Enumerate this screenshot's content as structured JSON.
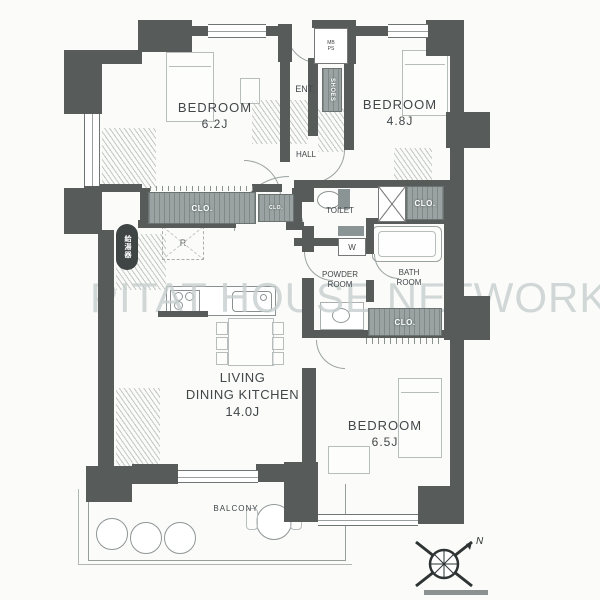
{
  "watermark": "PITAT HOUSE NETWORK",
  "rooms": {
    "bedroom1": {
      "label": "BEDROOM",
      "size": "6.2J"
    },
    "bedroom2": {
      "label": "BEDROOM",
      "size": "4.8J"
    },
    "bedroom3": {
      "label": "BEDROOM",
      "size": "6.5J"
    },
    "ldk": {
      "line1": "LIVING",
      "line2": "DINING KITCHEN",
      "size": "14.0J"
    },
    "hall": {
      "label": "HALL"
    },
    "entrance": {
      "label": "ENT."
    },
    "toilet": {
      "label": "TOILET"
    },
    "powder": {
      "line1": "POWDER",
      "line2": "ROOM"
    },
    "bath": {
      "line1": "BATH",
      "line2": "ROOM"
    },
    "balcony": {
      "label": "BALCONY"
    }
  },
  "fixtures": {
    "closet": "CLO.",
    "shoes": "SHOES",
    "meter_box": "MB PS",
    "washer": "W",
    "refrigerator": "R",
    "water_heater": "給湯器"
  },
  "compass": {
    "north": "N"
  },
  "colors": {
    "wall": "#575c5b",
    "closet_fill": "#9aa2a2",
    "watermark": "#c6cfce",
    "background": "#fbfbf9"
  }
}
